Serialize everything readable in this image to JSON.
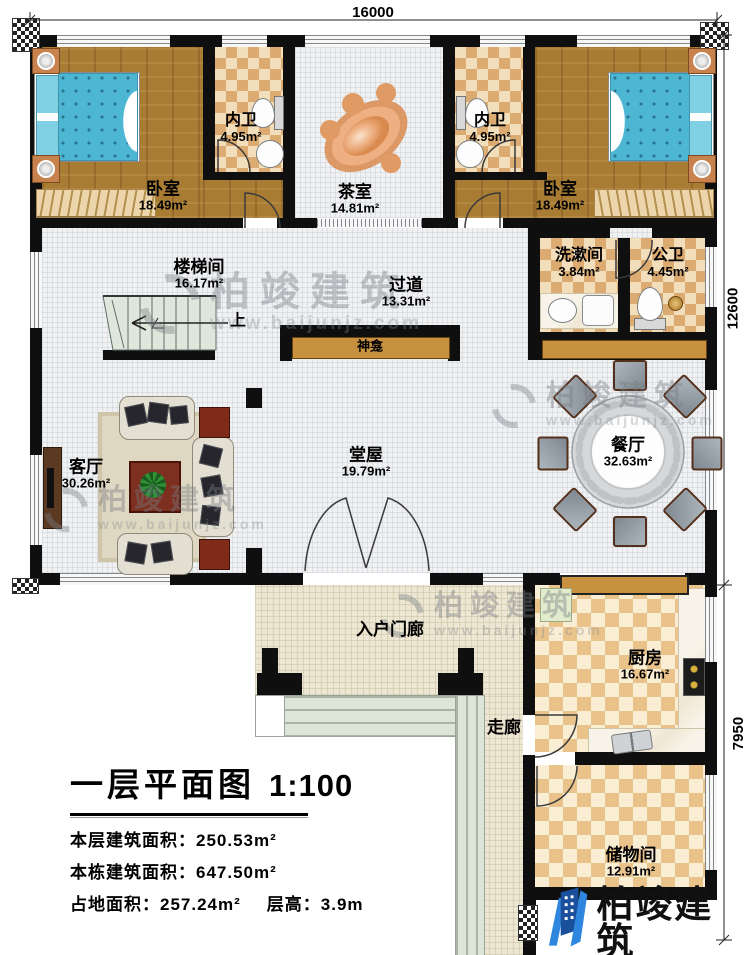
{
  "dimensions": {
    "top": "16000",
    "upper_right": "12600",
    "lower_right": "7950"
  },
  "rooms": {
    "bedroom_left": {
      "name": "卧室",
      "area": "18.49m²"
    },
    "ensuite_left": {
      "name": "内卫",
      "area": "4.95m²"
    },
    "tea_room": {
      "name": "茶室",
      "area": "14.81m²"
    },
    "ensuite_right": {
      "name": "内卫",
      "area": "4.95m²"
    },
    "bedroom_right": {
      "name": "卧室",
      "area": "18.49m²"
    },
    "stairwell": {
      "name": "楼梯间",
      "area": "16.17m²"
    },
    "hallway": {
      "name": "过道",
      "area": "13.31m²"
    },
    "washroom": {
      "name": "洗漱间",
      "area": "3.84m²"
    },
    "public_bath": {
      "name": "公卫",
      "area": "4.45m²"
    },
    "living_room": {
      "name": "客厅",
      "area": "30.26m²"
    },
    "main_hall": {
      "name": "堂屋",
      "area": "19.79m²"
    },
    "dining_room": {
      "name": "餐厅",
      "area": "32.63m²"
    },
    "entry_porch": {
      "name": "入户门廊"
    },
    "kitchen": {
      "name": "厨房",
      "area": "16.67m²"
    },
    "corridor": {
      "name": "走廊"
    },
    "storage": {
      "name": "储物间",
      "area": "12.91m²"
    }
  },
  "annotations": {
    "stairs_up": "上",
    "shrine": "神龛"
  },
  "title_block": {
    "title": "一层平面图",
    "scale": "1:100",
    "floor_area_label": "本层建筑面积：",
    "floor_area": "250.53m²",
    "building_area_label": "本栋建筑面积：",
    "building_area": "647.50m²",
    "footprint_label": "占地面积：",
    "footprint": "257.24m²",
    "height_label": "层高：",
    "height": "3.9m"
  },
  "brand": {
    "name": "柏竣建筑",
    "url": "www.baijunjz.com"
  }
}
